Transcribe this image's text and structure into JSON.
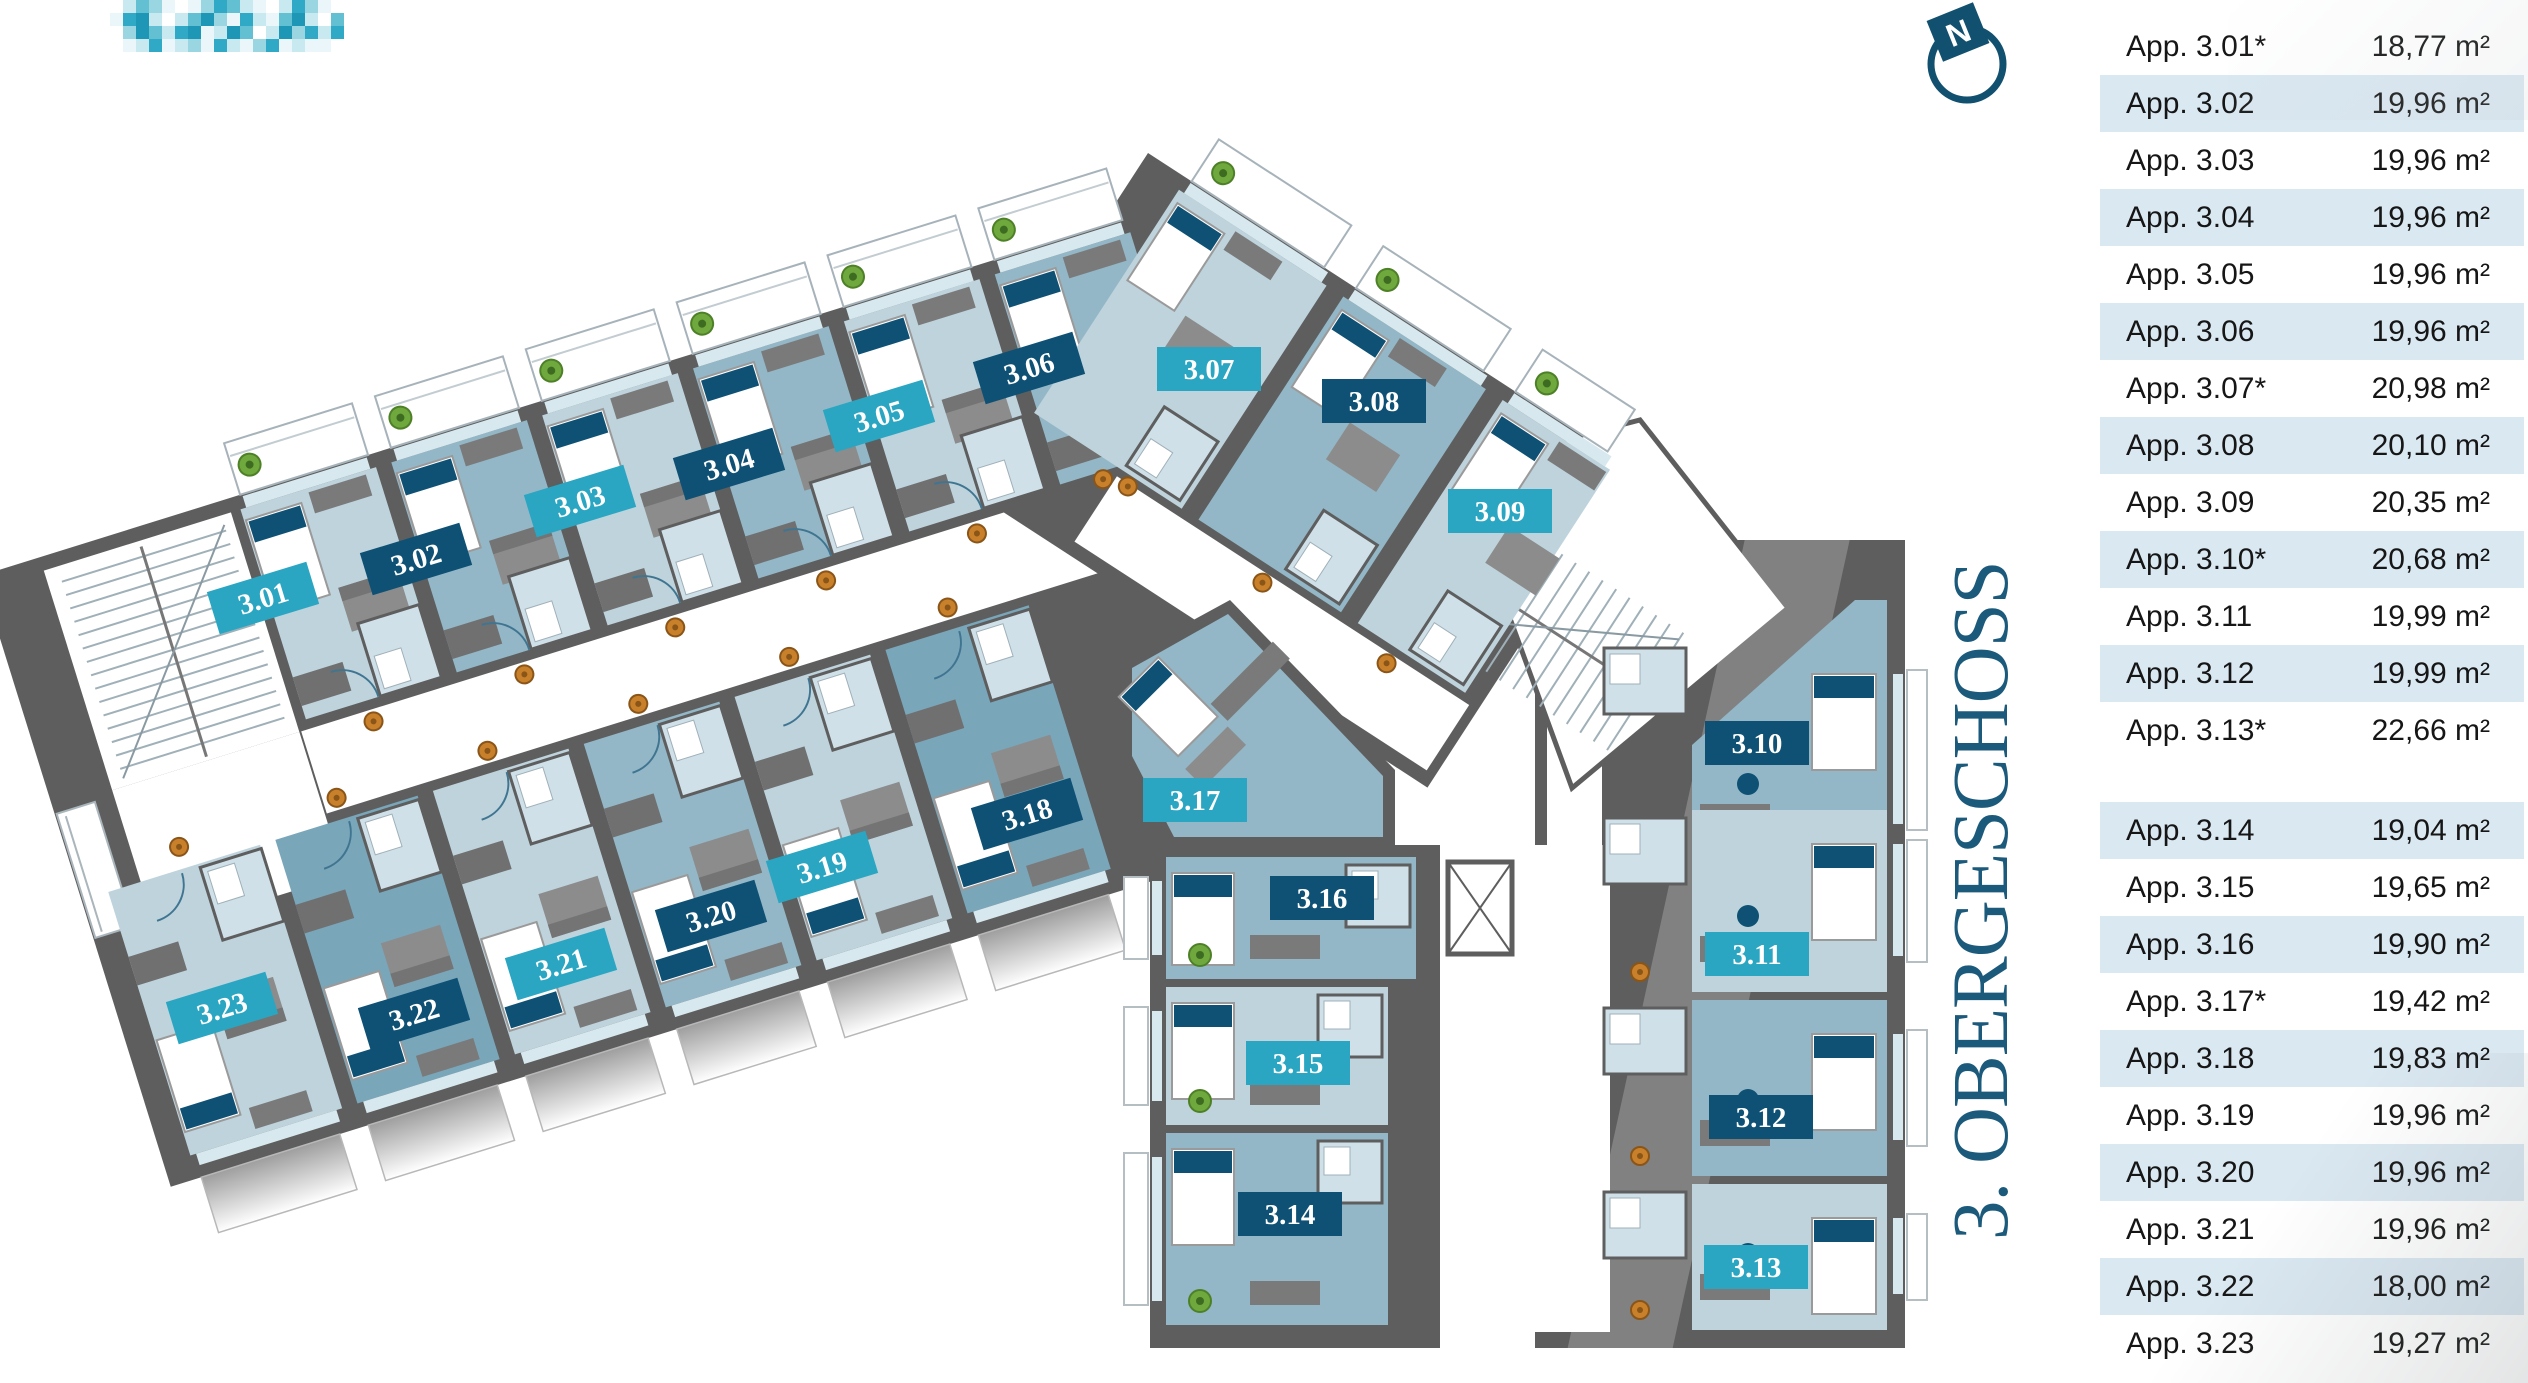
{
  "title": {
    "text": "3. OBERGESCHOSS"
  },
  "compass": {
    "label": "N"
  },
  "logo": {
    "name": "pixelated-logo",
    "palette": [
      "transparent",
      "#eaf6f9",
      "#c9e9f0",
      "#9ad6e2",
      "#62c0d2",
      "#2fa9c5",
      "#1e97b7"
    ],
    "pixels": [
      [
        0,
        2,
        4,
        3,
        1,
        0,
        1,
        3,
        5,
        4,
        2,
        1,
        0,
        2,
        5,
        3,
        1,
        0
      ],
      [
        1,
        5,
        6,
        2,
        0,
        2,
        4,
        6,
        3,
        1,
        5,
        2,
        1,
        4,
        6,
        2,
        0,
        4
      ],
      [
        0,
        3,
        6,
        4,
        2,
        5,
        6,
        1,
        2,
        6,
        4,
        0,
        2,
        6,
        3,
        5,
        2,
        5
      ],
      [
        0,
        1,
        2,
        5,
        1,
        2,
        3,
        1,
        5,
        2,
        1,
        3,
        5,
        1,
        2,
        1,
        1,
        0
      ]
    ]
  },
  "units_table": {
    "rows": [
      {
        "label": "App. 3.01*",
        "area": "18,77 m²",
        "shaded": false
      },
      {
        "label": "App. 3.02",
        "area": "19,96 m²",
        "shaded": true
      },
      {
        "label": "App. 3.03",
        "area": "19,96 m²",
        "shaded": false
      },
      {
        "label": "App. 3.04",
        "area": "19,96 m²",
        "shaded": true
      },
      {
        "label": "App. 3.05",
        "area": "19,96 m²",
        "shaded": false
      },
      {
        "label": "App. 3.06",
        "area": "19,96 m²",
        "shaded": true
      },
      {
        "label": "App. 3.07*",
        "area": "20,98 m²",
        "shaded": false
      },
      {
        "label": "App. 3.08",
        "area": "20,10 m²",
        "shaded": true
      },
      {
        "label": "App. 3.09",
        "area": "20,35 m²",
        "shaded": false
      },
      {
        "label": "App. 3.10*",
        "area": "20,68 m²",
        "shaded": true
      },
      {
        "label": "App. 3.11",
        "area": "19,99 m²",
        "shaded": false
      },
      {
        "label": "App. 3.12",
        "area": "19,99 m²",
        "shaded": true
      },
      {
        "label": "App. 3.13*",
        "area": "22,66 m²",
        "shaded": false,
        "group_end": true
      },
      {
        "label": "App. 3.14",
        "area": "19,04 m²",
        "shaded": true
      },
      {
        "label": "App. 3.15",
        "area": "19,65 m²",
        "shaded": false
      },
      {
        "label": "App. 3.16",
        "area": "19,90 m²",
        "shaded": true
      },
      {
        "label": "App. 3.17*",
        "area": "19,42 m²",
        "shaded": false
      },
      {
        "label": "App. 3.18",
        "area": "19,83 m²",
        "shaded": true
      },
      {
        "label": "App. 3.19",
        "area": "19,96 m²",
        "shaded": false
      },
      {
        "label": "App. 3.20",
        "area": "19,96 m²",
        "shaded": true
      },
      {
        "label": "App. 3.21",
        "area": "19,96 m²",
        "shaded": false
      },
      {
        "label": "App. 3.22",
        "area": "18,00 m²",
        "shaded": true
      },
      {
        "label": "App. 3.23",
        "area": "19,27 m²",
        "shaded": false
      }
    ]
  },
  "colors": {
    "badge_teal": "#2aa6c2",
    "badge_navy": "#0e5174",
    "wall": "#5e5e5e",
    "floor_light": "#bed3dc",
    "floor_med": "#93b7c7",
    "floor_dark": "#7aa6ba",
    "bath": "#cfe0e8",
    "window": "#d7e9ef",
    "accent": "#0e5174",
    "plant_green": "#6fa83c",
    "plant_orange": "#c9802b",
    "table_shade": "#dae8f2",
    "title_color": "#1c5a7c"
  },
  "plan": {
    "badges": [
      {
        "label": "3.01",
        "x": 263,
        "y": 598,
        "variant": "teal",
        "rot": -17
      },
      {
        "label": "3.02",
        "x": 416,
        "y": 559,
        "variant": "navy",
        "rot": -17
      },
      {
        "label": "3.03",
        "x": 580,
        "y": 501,
        "variant": "teal",
        "rot": -17
      },
      {
        "label": "3.04",
        "x": 729,
        "y": 464,
        "variant": "navy",
        "rot": -17
      },
      {
        "label": "3.05",
        "x": 879,
        "y": 416,
        "variant": "teal",
        "rot": -17
      },
      {
        "label": "3.06",
        "x": 1029,
        "y": 368,
        "variant": "navy",
        "rot": -17
      },
      {
        "label": "3.07",
        "x": 1209,
        "y": 369,
        "variant": "teal",
        "rot": 0
      },
      {
        "label": "3.08",
        "x": 1374,
        "y": 401,
        "variant": "navy",
        "rot": 0
      },
      {
        "label": "3.09",
        "x": 1500,
        "y": 511,
        "variant": "teal",
        "rot": 0
      },
      {
        "label": "3.10",
        "x": 1757,
        "y": 743,
        "variant": "navy",
        "rot": 0
      },
      {
        "label": "3.11",
        "x": 1757,
        "y": 954,
        "variant": "teal",
        "rot": 0
      },
      {
        "label": "3.12",
        "x": 1761,
        "y": 1117,
        "variant": "navy",
        "rot": 0
      },
      {
        "label": "3.13",
        "x": 1756,
        "y": 1267,
        "variant": "teal",
        "rot": 0
      },
      {
        "label": "3.14",
        "x": 1290,
        "y": 1214,
        "variant": "navy",
        "rot": 0
      },
      {
        "label": "3.15",
        "x": 1298,
        "y": 1063,
        "variant": "teal",
        "rot": 0
      },
      {
        "label": "3.16",
        "x": 1322,
        "y": 898,
        "variant": "navy",
        "rot": 0
      },
      {
        "label": "3.17",
        "x": 1195,
        "y": 800,
        "variant": "teal",
        "rot": 0
      },
      {
        "label": "3.18",
        "x": 1027,
        "y": 814,
        "variant": "navy",
        "rot": -17
      },
      {
        "label": "3.19",
        "x": 822,
        "y": 867,
        "variant": "teal",
        "rot": -17
      },
      {
        "label": "3.20",
        "x": 711,
        "y": 916,
        "variant": "navy",
        "rot": -17
      },
      {
        "label": "3.21",
        "x": 561,
        "y": 964,
        "variant": "teal",
        "rot": -17
      },
      {
        "label": "3.22",
        "x": 414,
        "y": 1014,
        "variant": "navy",
        "rot": -17
      },
      {
        "label": "3.23",
        "x": 222,
        "y": 1008,
        "variant": "teal",
        "rot": -17
      }
    ],
    "wings": [
      {
        "id": "left-top",
        "type": "h-top",
        "rooms": [
          {
            "n": "3.01",
            "x": 140,
            "w": 158
          },
          {
            "n": "3.02",
            "x": 298,
            "w": 158
          },
          {
            "n": "3.03",
            "x": 456,
            "w": 158
          },
          {
            "n": "3.04",
            "x": 614,
            "w": 158
          },
          {
            "n": "3.05",
            "x": 772,
            "w": 158
          },
          {
            "n": "3.06",
            "x": 930,
            "w": 158
          }
        ]
      },
      {
        "id": "left-bottom",
        "type": "h-bottom",
        "rooms": [
          {
            "n": "3.23",
            "x": -100,
            "w": 175
          },
          {
            "n": "3.22",
            "x": 75,
            "w": 165
          },
          {
            "n": "3.21",
            "x": 240,
            "w": 158
          },
          {
            "n": "3.20",
            "x": 398,
            "w": 158
          },
          {
            "n": "3.19",
            "x": 556,
            "w": 158
          },
          {
            "n": "3.18",
            "x": 714,
            "w": 166
          }
        ]
      },
      {
        "id": "junction",
        "type": "jx",
        "rooms": [
          {
            "n": "3.07",
            "x": 40,
            "w": 188
          },
          {
            "n": "3.08",
            "x": 236,
            "w": 182
          },
          {
            "n": "3.09",
            "x": 426,
            "w": 140
          }
        ]
      },
      {
        "id": "right",
        "type": "v-right",
        "rooms": [
          {
            "n": "3.10",
            "y": 585,
            "h": 220
          },
          {
            "n": "3.11",
            "y": 810,
            "h": 182
          },
          {
            "n": "3.12",
            "y": 1000,
            "h": 176
          },
          {
            "n": "3.13",
            "y": 1184,
            "h": 146
          }
        ]
      },
      {
        "id": "bottom",
        "type": "v-bottom",
        "rooms": [
          {
            "n": "3.16",
            "y": 857,
            "h": 122
          },
          {
            "n": "3.15",
            "y": 987,
            "h": 138
          },
          {
            "n": "3.14",
            "y": 1133,
            "h": 192
          }
        ]
      }
    ]
  }
}
